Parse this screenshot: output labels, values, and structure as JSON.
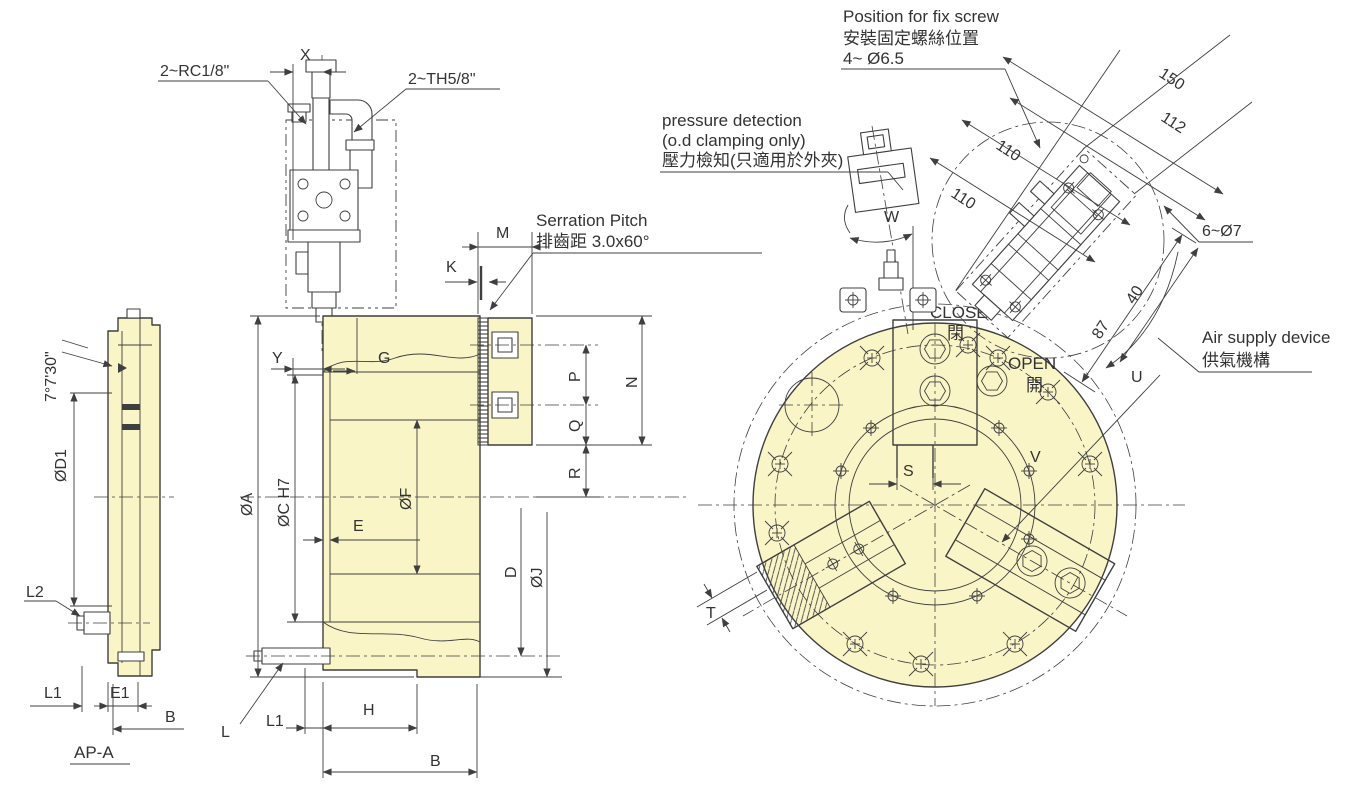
{
  "colors": {
    "body_fill": "#FAF5C6",
    "line": "#3f3f3f",
    "text": "#333333",
    "background": "#ffffff"
  },
  "adapter": {
    "title": "AP-A",
    "angle": "7°7'30\"",
    "phiD1": "ØD1",
    "L2": "L2",
    "L1": "L1",
    "E1": "E1",
    "B": "B"
  },
  "section": {
    "rc": "2~RC1/8\"",
    "x": "X",
    "th": "2~TH5/8\"",
    "serration_en": "Serration Pitch",
    "serration_zh": "排齒距 3.0x60°",
    "M": "M",
    "K": "K",
    "Y": "Y",
    "G": "G",
    "phiA": "ØA",
    "phiC": "ØC H7",
    "phiF": "ØF",
    "E": "E",
    "P": "P",
    "Q": "Q",
    "N": "N",
    "R": "R",
    "D": "D",
    "phiJ": "ØJ",
    "L": "L",
    "L1": "L1",
    "H": "H",
    "B": "B"
  },
  "front": {
    "pressure1": "pressure detection",
    "pressure2": "(o.d clamping only)",
    "pressure3": "壓力檢知(只適用於外夾)",
    "fix1": "Position for fix screw",
    "fix2": "安裝固定螺絲位置",
    "fix3": "4~ Ø6.5",
    "air1": "Air supply device",
    "air2": "供氣機構",
    "close": "CLOSE",
    "close_zh": "閉",
    "open": "OPEN",
    "open_zh": "開",
    "d150": "150",
    "d112": "112",
    "d110a": "110",
    "d110b": "110",
    "d87": "87",
    "d40": "40",
    "holes": "6~Ø7",
    "S": "S",
    "T": "T",
    "U": "U",
    "V": "V",
    "W": "W"
  }
}
